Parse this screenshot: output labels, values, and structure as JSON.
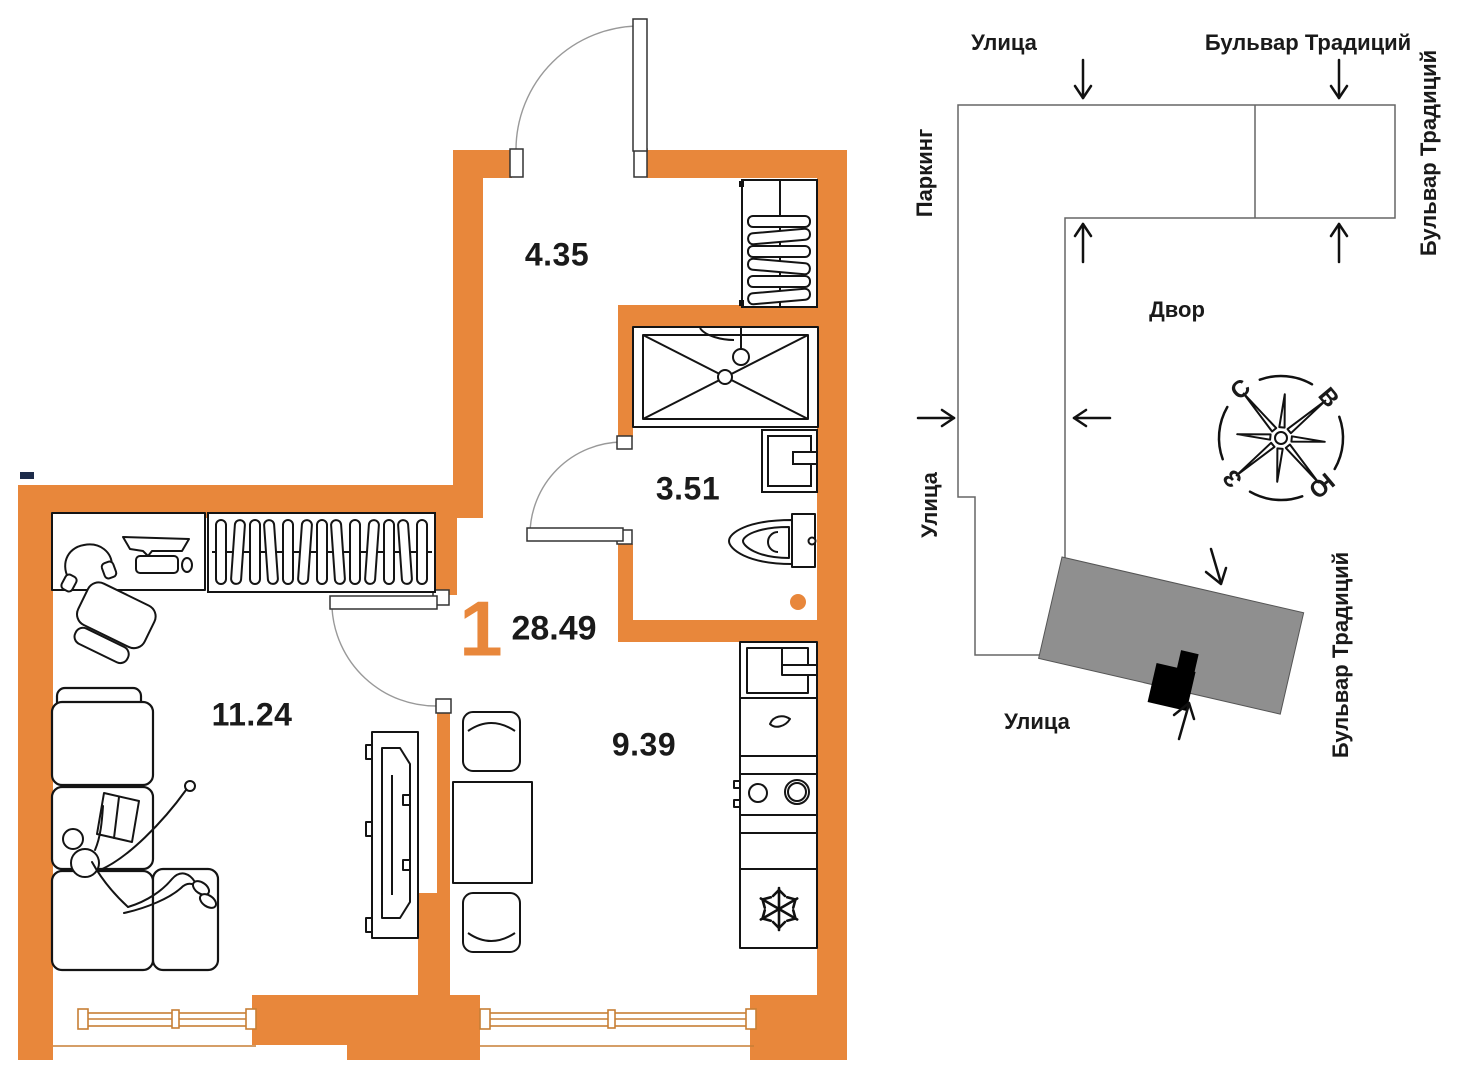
{
  "floor_plan": {
    "apartment_number": "1",
    "total_area": "28.49",
    "rooms": {
      "hallway": {
        "area": "4.35"
      },
      "bathroom": {
        "area": "3.51"
      },
      "living_room": {
        "area": "11.24"
      },
      "kitchen": {
        "area": "9.39"
      }
    },
    "accent_color": "#E8873B"
  },
  "site_plan": {
    "street_top": "Улица",
    "boulevard_top": "Бульвар Традиций",
    "parking": "Паркинг",
    "boulevard_right": "Бульвар Традиций",
    "courtyard": "Двор",
    "street_left": "Улица",
    "street_bottom": "Улица",
    "boulevard_bottom": "Бульвар Традиций",
    "compass": {
      "north": "С",
      "east": "В",
      "south": "Ю",
      "west": "З"
    },
    "building_fill": "#8F8F8F"
  }
}
